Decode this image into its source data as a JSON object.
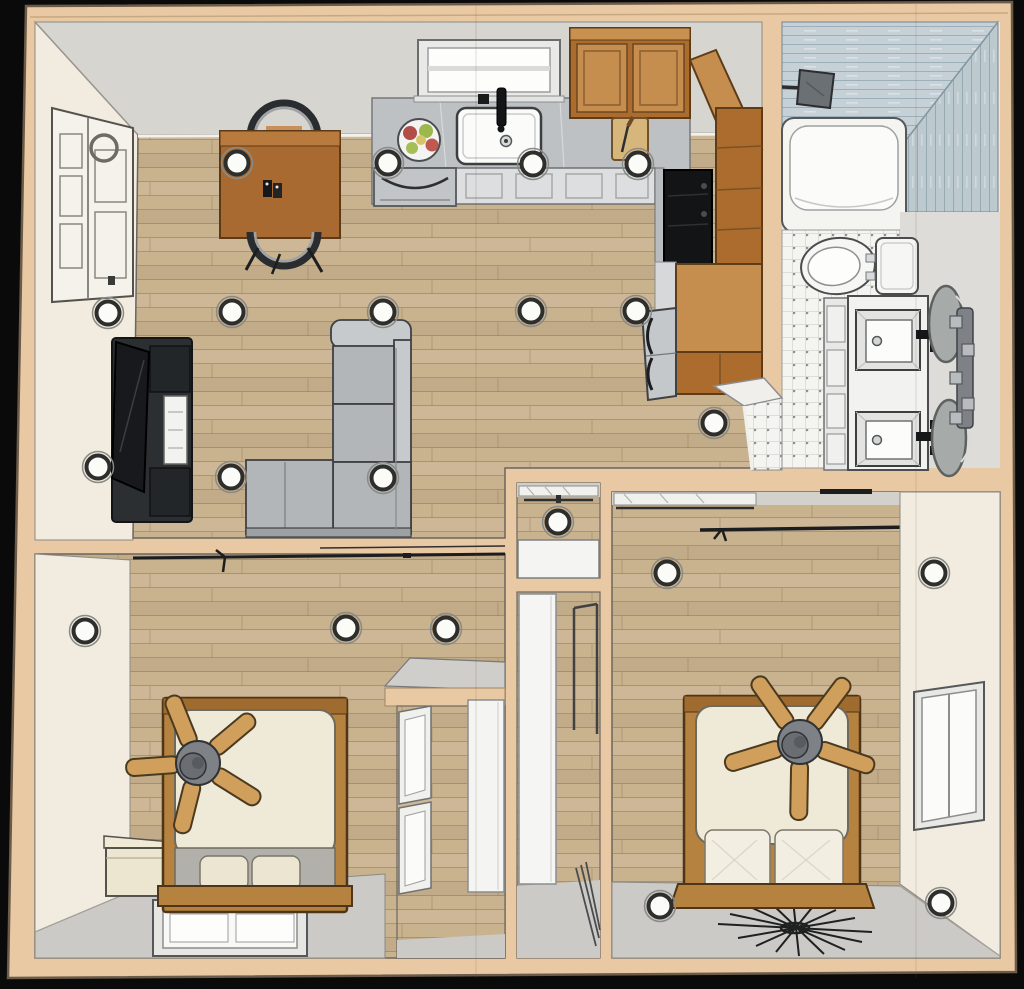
{
  "scene": {
    "title": "3d-floor-plan-top-down-render",
    "rooms": [
      {
        "name": "living-dining-area",
        "floor": "wood-plank",
        "furniture": [
          "dining-table",
          "dining-chair",
          "dining-chair",
          "sectional-sofa",
          "media-console-fireplace",
          "front-door"
        ]
      },
      {
        "name": "kitchen",
        "floor": "wood-plank",
        "furniture": [
          "counter",
          "farmhouse-sink",
          "faucet",
          "window",
          "fruit-bowl",
          "dishwasher",
          "base-cabinets",
          "upper-cabinets",
          "corner-cabinet",
          "cutting-board",
          "range",
          "pantry-cabinet",
          "island-cabinet",
          "refrigerator"
        ]
      },
      {
        "name": "bathroom",
        "floor": "white-tile",
        "furniture": [
          "walk-in-shower",
          "shower-head",
          "bathtub",
          "toilet",
          "vanity-counter",
          "sink",
          "sink",
          "round-mirror",
          "round-mirror",
          "sconce-light-bar",
          "door-opening"
        ]
      },
      {
        "name": "hall-closet",
        "floor": "wood-plank",
        "furniture": [
          "shelf-with-rod",
          "closet-door"
        ]
      },
      {
        "name": "entry-hall",
        "floor": "wood-plank",
        "furniture": [
          "white-door",
          "door-frame"
        ]
      },
      {
        "name": "bedroom-left",
        "floor": "wood-plank",
        "furniture": [
          "bed",
          "ceiling-fan",
          "nightstand",
          "curtain-rod",
          "window",
          "closet"
        ]
      },
      {
        "name": "bedroom-right",
        "floor": "wood-plank",
        "furniture": [
          "bed",
          "ceiling-fan",
          "closet-shelf",
          "curtain-rod",
          "window",
          "starburst-decor"
        ]
      }
    ]
  },
  "colors": {
    "background": "#0a0a0a",
    "wall_band": "#e9c9a3",
    "wall_band_edge": "#6b5b49",
    "wall_cream": "#f1ecdf",
    "wall_gray": "#d7d5d0",
    "wall_gray_dark": "#cbcac6",
    "floor_wood": "#c9b28e",
    "plank_line": "#8f7a55",
    "counter": "#bdc1c4",
    "cabinet": "#ab6c2d",
    "cabinet_light": "#c68e4e",
    "table": "#a96a31",
    "sofa": "#b2b6b9",
    "sofa_light": "#c7cacc",
    "black_unit": "#2c2f32",
    "tv": "#17191c",
    "bed_frame": "#b5823f",
    "mattress": "#efe9d7",
    "pillow": "#ece5d1",
    "blanket": "#b2b0ab",
    "fan_blade": "#cf9f5b",
    "fan_hub": "#7e8286",
    "tile_base": "#f4f4f1",
    "shower_tile_h": "#c6d1d7",
    "shower_tile_v": "#bcc9cf",
    "mirror": "#a6aaa9",
    "fixture": "#7e8286",
    "light_fill": "#fbfbf8",
    "light_ring": "#2e2e2c"
  },
  "recessed_lights": [
    [
      237,
      163
    ],
    [
      388,
      163
    ],
    [
      533,
      164
    ],
    [
      638,
      164
    ],
    [
      108,
      313
    ],
    [
      232,
      312
    ],
    [
      383,
      312
    ],
    [
      531,
      311
    ],
    [
      636,
      311
    ],
    [
      98,
      467
    ],
    [
      231,
      477
    ],
    [
      383,
      478
    ],
    [
      714,
      423
    ],
    [
      558,
      522
    ],
    [
      85,
      631
    ],
    [
      346,
      628
    ],
    [
      446,
      629
    ],
    [
      667,
      573
    ],
    [
      934,
      573
    ],
    [
      660,
      906
    ],
    [
      941,
      903
    ]
  ],
  "ceiling_fans": [
    {
      "cx": 198,
      "cy": 763,
      "r": 72,
      "angle": -22
    },
    {
      "cx": 800,
      "cy": 742,
      "r": 78,
      "angle": -35
    }
  ]
}
